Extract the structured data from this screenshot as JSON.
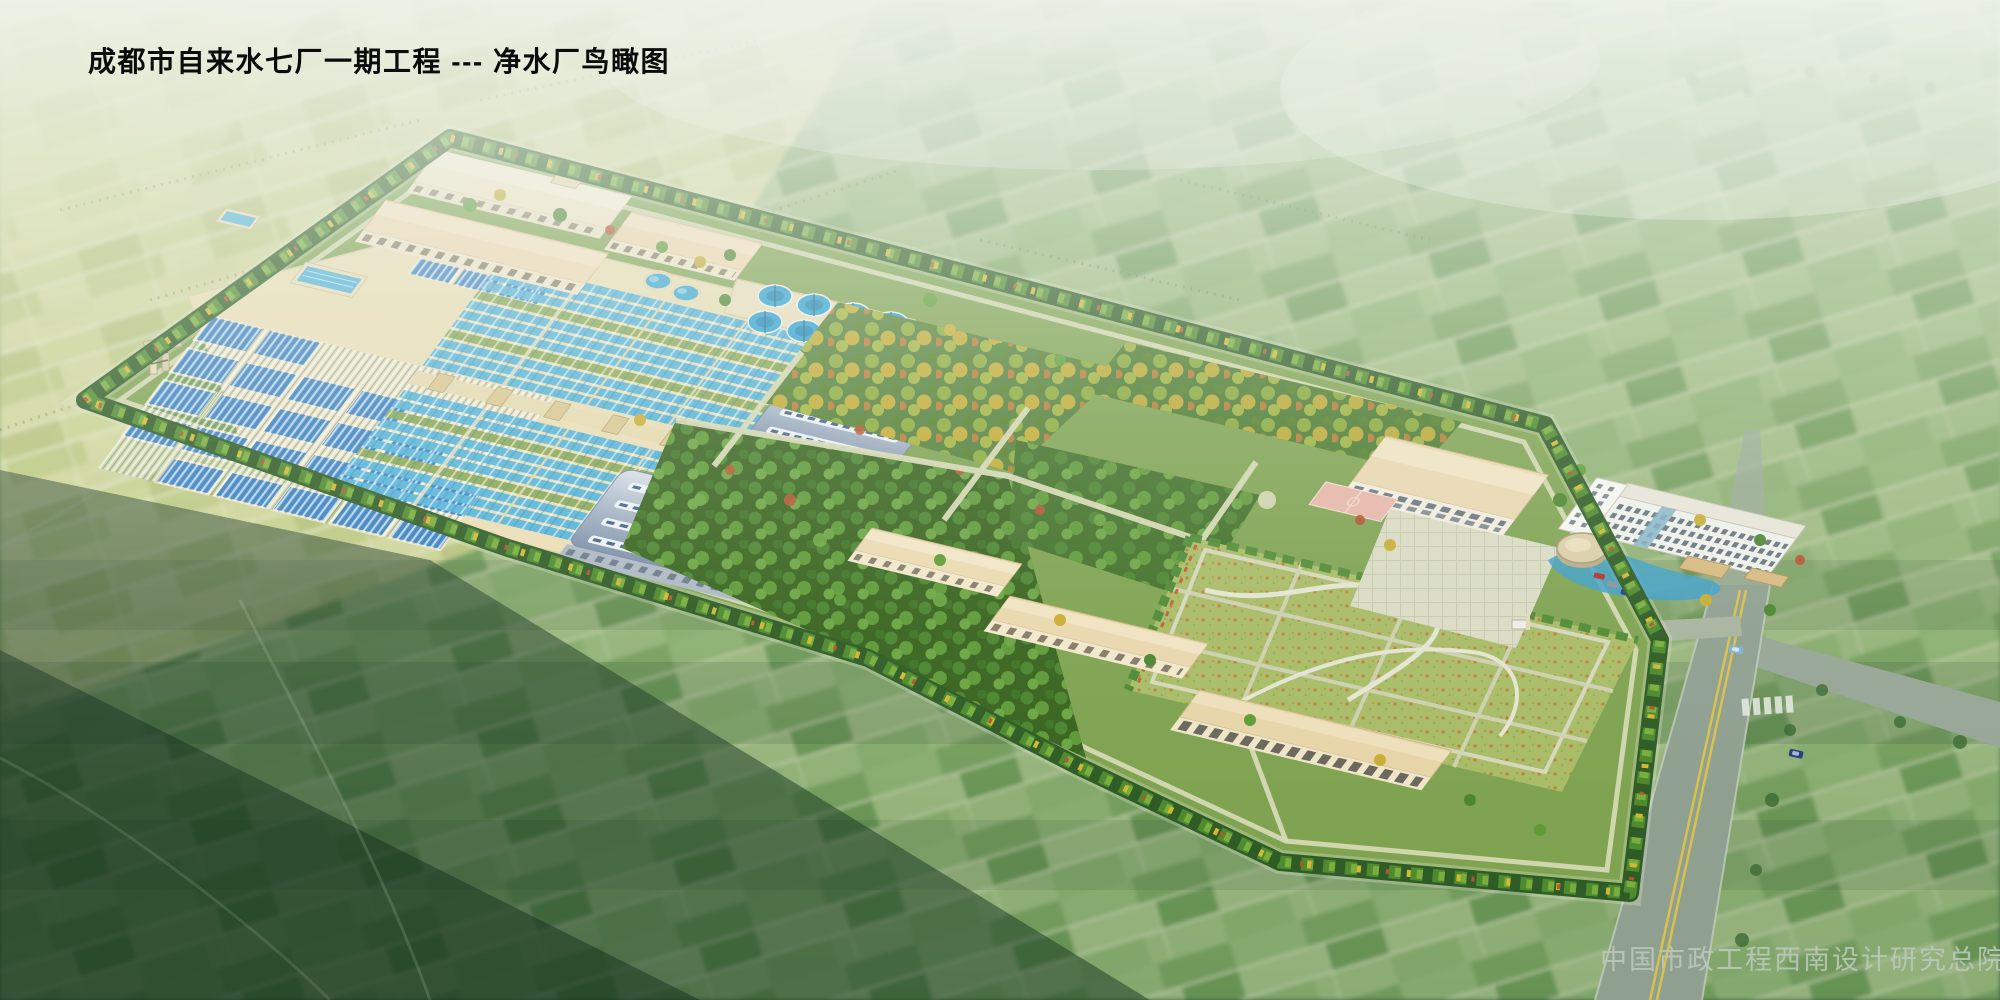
{
  "header": {
    "title": "成都市自来水七厂一期工程 --- 净水厂鸟瞰图"
  },
  "footer": {
    "credit": "中国市政工程西南设计研究总院"
  },
  "palette": {
    "haze_white": "#ecf2ea",
    "field_yellow_green": "#ccd18f",
    "field_green": "#8db273",
    "dark_farmland": "#27492c",
    "site_lawn_green": "#7fa351",
    "tree_belt_dark": "#2f5c26",
    "tree_green": "#4e8a2e",
    "tree_autumn_yellow": "#d3b832",
    "tree_autumn_red": "#b4552c",
    "basin_water_blue": "#52b4da",
    "basin_cover_blue": "#3e86c8",
    "clarifier_blue": "#2ba0d4",
    "arch_roof_blue_gray": "#9fb0c4",
    "building_cream": "#f2e6c8",
    "roof_tan_pink": "#ecd4ac",
    "meadow_lawn": "#a9bc67",
    "court_pink": "#e8b6aa",
    "road_gray": "#8fa091",
    "path_beige": "#d8dab6",
    "road_center_line_yellow": "#d9c14b",
    "title_color": "#0b0b0b",
    "credit_color": "#bac8ba"
  }
}
